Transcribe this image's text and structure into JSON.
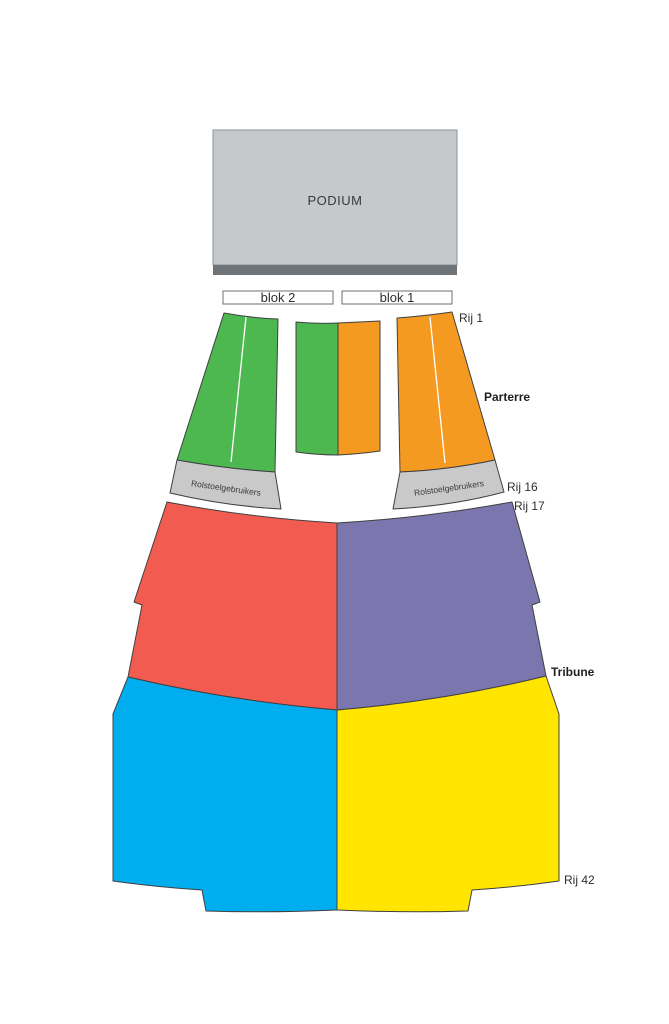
{
  "podium": {
    "label": "PODIUM"
  },
  "blocks": {
    "blok2": "blok 2",
    "blok1": "blok 1"
  },
  "parterre": {
    "label": "Parterre",
    "wheelchair_label": "Rolstoelgebruikers"
  },
  "tribune": {
    "label": "Tribune"
  },
  "rows": {
    "rij1": "Rij 1",
    "rij16": "Rij 16",
    "rij17": "Rij 17",
    "rij42": "Rij 42"
  },
  "colors": {
    "podium": "#c5c9cc",
    "podium_edge": "#6f7478",
    "green": "#4cb84f",
    "orange": "#f49a20",
    "red": "#f15b50",
    "purple": "#7b76ad",
    "blue": "#00aeef",
    "yellow": "#ffe500",
    "wheelchair": "#c9c9ca"
  }
}
